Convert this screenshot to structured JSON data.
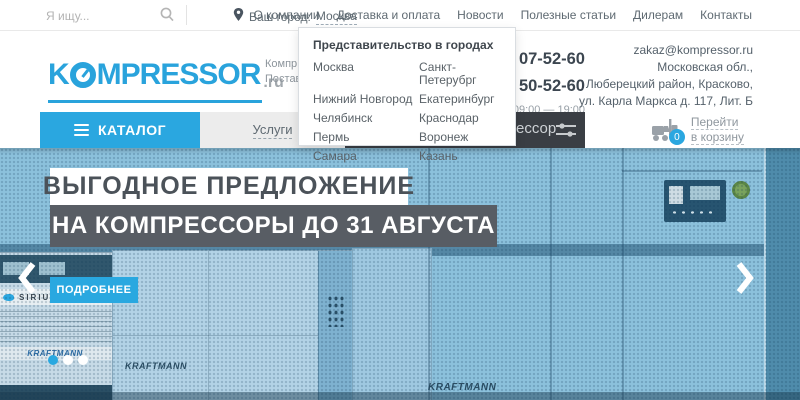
{
  "topbar": {
    "search_placeholder": "Я ищу...",
    "city_label": "Ваш город:",
    "city_value": "Москва",
    "nav": [
      "О компании",
      "Доставка и оплата",
      "Новости",
      "Полезные статьи",
      "Дилерам",
      "Контакты"
    ]
  },
  "header": {
    "logo_part1": "K",
    "logo_part2": "MPRESSOR",
    "logo_suffix": ".ru",
    "tagline_line1": "Компр",
    "tagline_line2": "Постав",
    "phone1": "07-52-60",
    "phone2": "50-52-60",
    "hours": "09:00 — 19:00",
    "email": "zakaz@kompressor.ru",
    "address_line1": "Московская обл.,",
    "address_line2": "Люберецкий район, Красково,",
    "address_line3": "ул. Карла Маркса д. 117, Лит. Б"
  },
  "city_dropdown": {
    "title": "Представительство в городах",
    "cities_col1": [
      "Москва",
      "Нижний Новгород",
      "Челябинск",
      "Пермь",
      "Самара"
    ],
    "cities_col2": [
      "Санкт-Петерубрг",
      "Екатеринбург",
      "Краснодар",
      "Воронеж",
      "Казань"
    ]
  },
  "menubar": {
    "catalog_label": "КАТАЛОГ",
    "services_label": "Услуги",
    "search_fragment": "ессор",
    "cart_count": "0",
    "cart_label_line1": "Перейти",
    "cart_label_line2": "в корзину"
  },
  "hero": {
    "banner_line1": "ВЫГОДНОЕ ПРЕДЛОЖЕНИЕ",
    "banner_line2": "НА КОМПРЕССОРЫ ДО 31 АВГУСТА",
    "cta_label": "ПОДРОБНЕЕ",
    "brand_sirius": "SIRIUS",
    "brand_kraftmann": "KRAFTMANN"
  },
  "icons": {
    "search": "magnifier",
    "location": "map-pin",
    "catalog": "hamburger-menu",
    "filter": "sliders",
    "cart": "forklift",
    "prev": "chevron-left",
    "next": "chevron-right"
  },
  "colors": {
    "accent_blue": "#2aa7e0",
    "menubar_dark": "#3a3e44",
    "banner_dark": "#585d64",
    "hero_blue": "#8cc1dc"
  }
}
